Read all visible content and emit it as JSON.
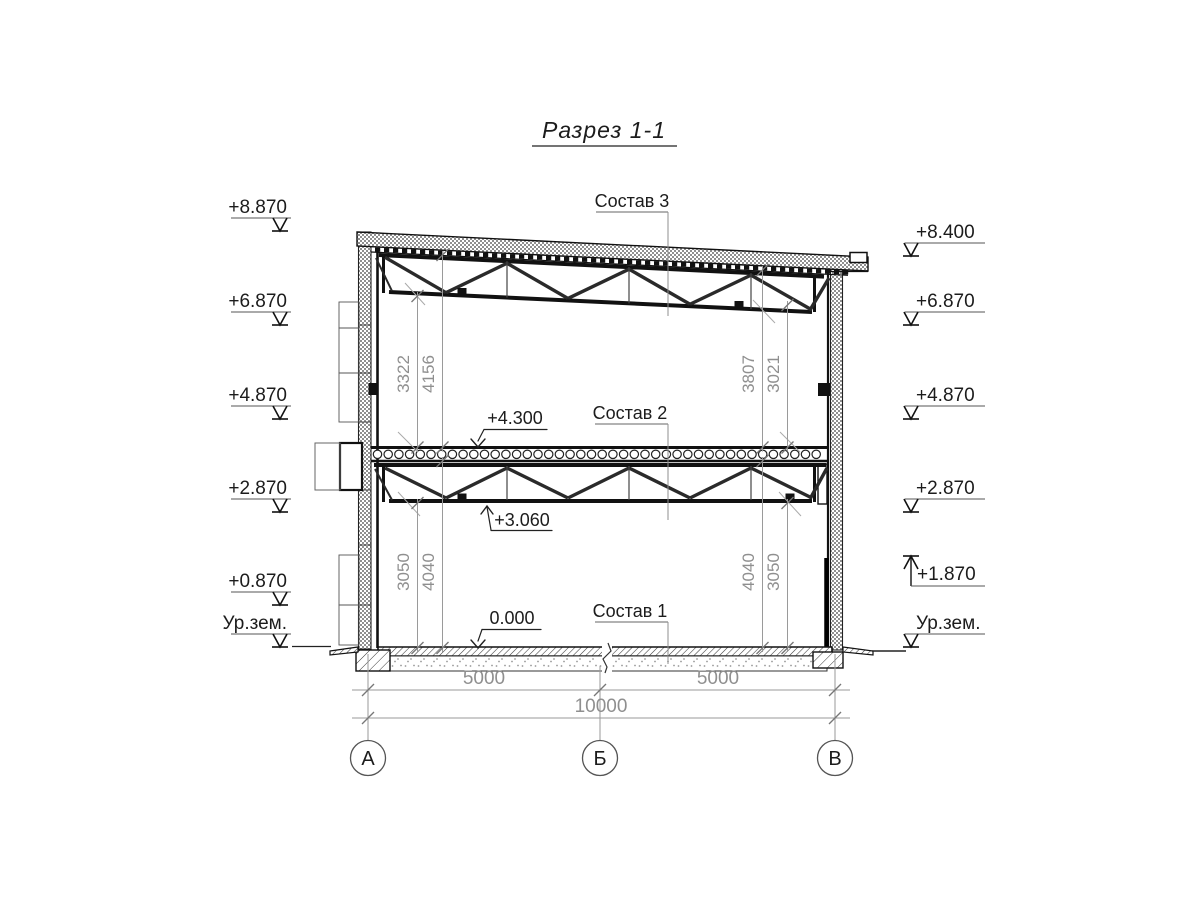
{
  "title": "Разрез 1-1",
  "layers": {
    "l3": "Состав 3",
    "l2": "Состав 2",
    "l1": "Состав 1"
  },
  "marks_left": [
    "+8.870",
    "+6.870",
    "+4.870",
    "+2.870",
    "+0.870",
    "Ур.зем."
  ],
  "marks_right": [
    "+8.400",
    "+6.870",
    "+4.870",
    "+2.870",
    "+1.870",
    "Ур.зем."
  ],
  "marks_inner": {
    "slab_top": "+4.300",
    "truss_chord": "+3.060",
    "floor": "0.000"
  },
  "dims": {
    "upper_left": [
      "3322",
      "4156"
    ],
    "upper_right": [
      "3807",
      "3021"
    ],
    "lower_left": [
      "3050",
      "4040"
    ],
    "lower_right": [
      "4040",
      "3050"
    ],
    "spans": [
      "5000",
      "5000"
    ],
    "total": "10000"
  },
  "axes": [
    "А",
    "Б",
    "В"
  ]
}
